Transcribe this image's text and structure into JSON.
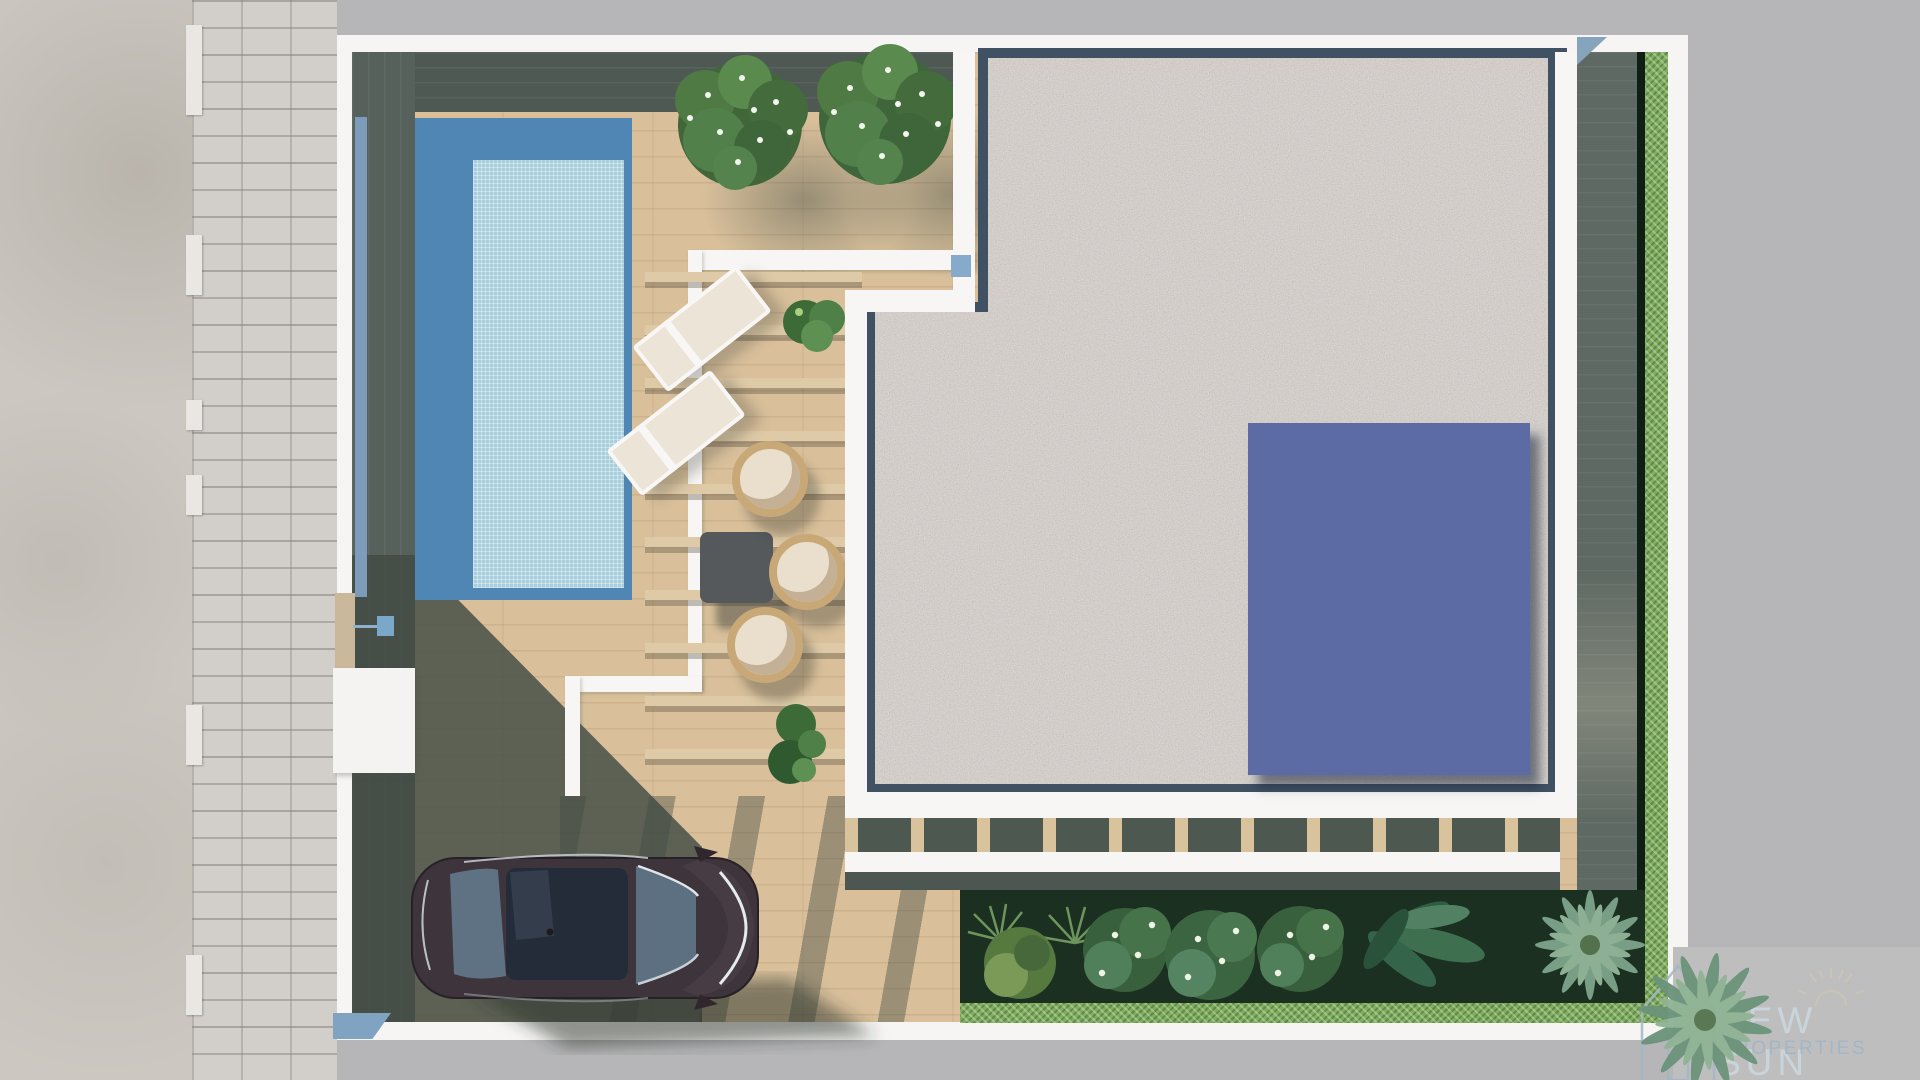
{
  "scene": {
    "description": "Aerial top-down 3D render of a villa plot with pool, pergola terrace, gravel roof with solar panels, garden and parked car",
    "watermark": {
      "brand_line1": "NEW SUN",
      "brand_line2": "PROPERTIES",
      "icons": [
        "house-outline-icon",
        "sun-icon"
      ]
    },
    "solar_array": {
      "rows": 4,
      "cols": 2,
      "panel_count": 8
    },
    "paver_caps": {
      "count": 6,
      "ys": [
        25,
        235,
        400,
        475,
        705,
        955
      ],
      "heights": [
        90,
        60,
        30,
        40,
        60,
        60
      ]
    },
    "furniture": {
      "sun_loungers": 2,
      "hanging_chairs": 3,
      "tables": 1
    },
    "vegetation": {
      "flowering_trees": 2,
      "garden_bushes": 6,
      "banana_plants": 1,
      "palm_trees": 2,
      "hedges": 2
    },
    "vehicles": {
      "cars": 1
    },
    "colors": {
      "surround_gray": "#b6b6b8",
      "sidewalk": "#ccc8c1",
      "pavers": "#d2cfca",
      "wall_white": "#f6f5f3",
      "deck_light": "#d9c09b",
      "deck_shadow": "#57615b",
      "pool_deep": "#4f86b3",
      "pool_shallow": "#a9cfdf",
      "gravel": "#b3aba6",
      "gravel_edging": "#3f5163",
      "solar_panel": "#7d8bc4",
      "solar_grid": "#5c6ba3",
      "hedge_green": "#7fae5c",
      "garden_bed": "#1b3020",
      "car_body": "#3e343b",
      "car_glass": "#5d7183",
      "accent_blue": "#7d9cb9",
      "logo_primary": "#c9d4db",
      "logo_secondary": "#a2b6c6"
    }
  }
}
